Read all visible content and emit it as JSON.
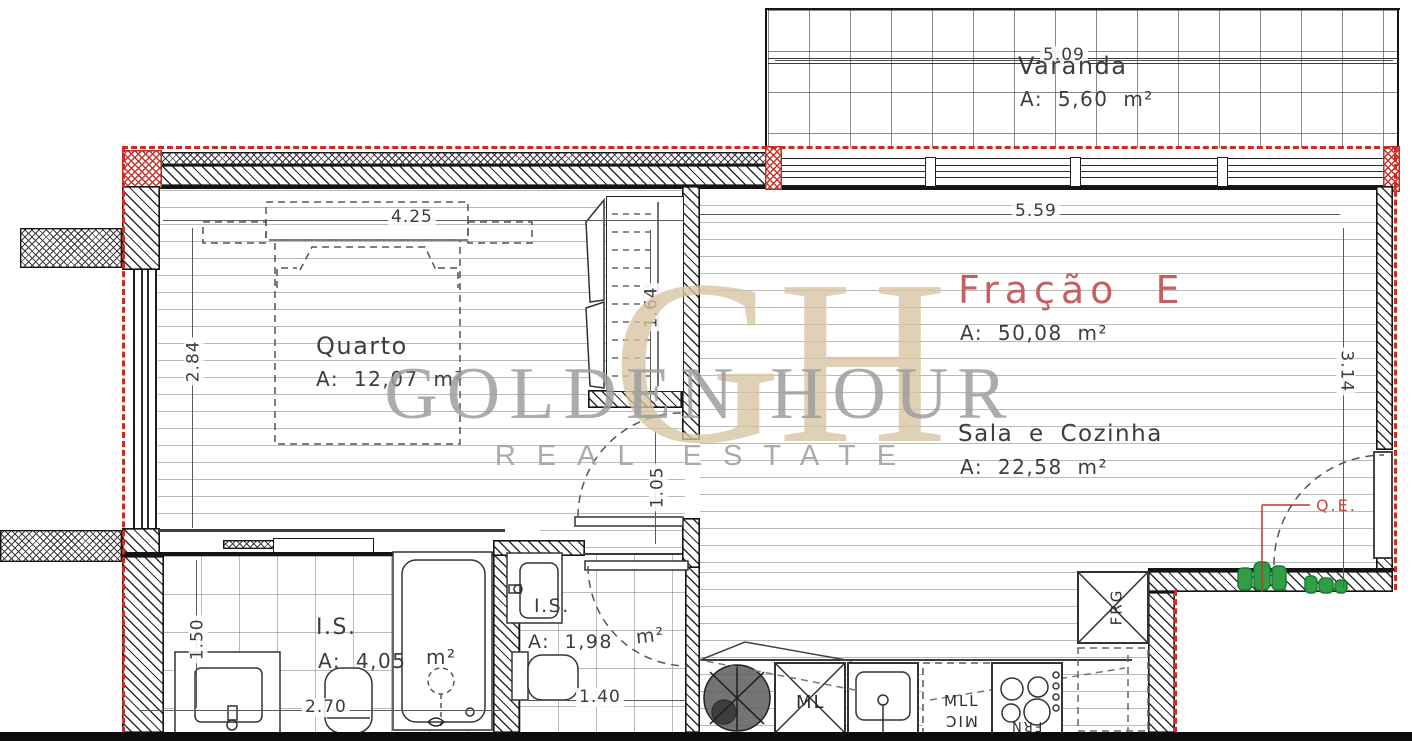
{
  "plan_title": "Fração E",
  "rooms": {
    "varanda": {
      "name": "Varanda",
      "area": "A:  5,60  m²",
      "dim_top": "5.09"
    },
    "sala": {
      "fraction": "Fração E",
      "fraction_area": "A:  50,08  m²",
      "name": "Sala e Cozinha",
      "area": "A:  22,58  m²",
      "dim_top": "5.59",
      "dim_right": "3.14"
    },
    "quarto": {
      "name": "Quarto",
      "area": "A:  12,07  m²",
      "dim_top": "4.25",
      "dim_left": "2.84"
    },
    "is1": {
      "name": "I.S.",
      "area": "A:  4,05",
      "area_unit": "m²",
      "dim_bottom": "2.70",
      "dim_left": "1.50"
    },
    "is2": {
      "name": "I.S.",
      "area": "A:  1,98",
      "area_unit": "m²",
      "dim_bottom": "1.40"
    },
    "wardrobe": {
      "dim": "1.64"
    },
    "hall": {
      "dim": "1.05"
    }
  },
  "kitchen_appliances": {
    "washing_machine": "ML",
    "dishwasher": "MLL",
    "microwave": "MIC",
    "oven": "FRN",
    "fridge": "FRG"
  },
  "electrical_panel": {
    "label": "Q.E."
  },
  "watermark": {
    "monogram": "GH",
    "title": "GOLDEN HOUR",
    "subtitle": "REAL ESTATE"
  },
  "colors": {
    "boundary_red": "#ce2b24",
    "fraction_text": "#c4605f",
    "qe_text": "#d2483c",
    "plant_green": "#2f9e44",
    "monogram_tan": "#d8c5a2",
    "watermark_gray": "#9e9e9e"
  }
}
